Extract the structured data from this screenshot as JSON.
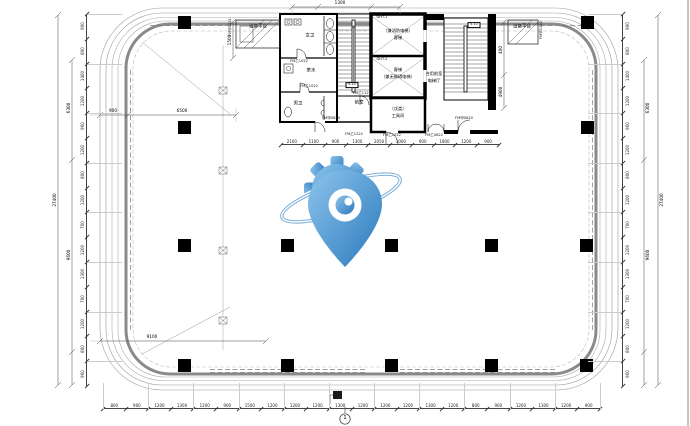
{
  "drawing": {
    "axis_bubble": "1",
    "rooms": {
      "equip_platform_left": "设备平台",
      "equip_platform_right": "设备平台",
      "women_toilet": "女卫",
      "tea_room": "茶水",
      "men_toilet": "男卫",
      "front_room": "前室",
      "lift1_tag": "DHT-1",
      "lift1_line1": "（兼消防电梯）",
      "lift1_line2": "客梯",
      "lift2_tag": "DHT-2",
      "lift2_line1": "客梯",
      "lift2_line2": "（兼无障碍电梯）",
      "tool_room_line1": "（戊类）",
      "tool_room_line2": "工具间",
      "lift_hall_line1": "合用前室",
      "lift_hall_line2": "电梯厅",
      "level_tag_1": "5.11",
      "level_tag_2": "5.11"
    },
    "door_codes": {
      "code0": "FM甲1221",
      "code1": "FM乙1022",
      "code2": "FM乙1022",
      "code3": "FM乙1121",
      "code4": "FM甲0820",
      "code5": "FM乙1222",
      "code6": "FM乙1022",
      "code7": "FM乙0822",
      "code8": "FM甲0820",
      "code9": "FM甲1222"
    },
    "dims": {
      "left_chain": [
        "900",
        "800",
        "1400",
        "1200",
        "900",
        "1200",
        "800",
        "1200",
        "700",
        "1200",
        "1300",
        "700",
        "1200",
        "800",
        "900"
      ],
      "right_chain": [
        "900",
        "800",
        "1400",
        "1200",
        "900",
        "1200",
        "800",
        "1200",
        "700",
        "1200",
        "1300",
        "700",
        "1200",
        "800",
        "900"
      ],
      "bottom_chain": [
        "800",
        "900",
        "1200",
        "1300",
        "1200",
        "900",
        "1500",
        "1200",
        "1200",
        "1200",
        "1300",
        "1200",
        "1200",
        "1200",
        "1300",
        "1200",
        "800",
        "900",
        "1200",
        "1300",
        "1200",
        "900"
      ],
      "core_bottom_chain": [
        "2100",
        "1100",
        "900",
        "1300",
        "2050",
        "1000",
        "900",
        "1800",
        "1200",
        "900"
      ],
      "left_subtotal_upper": "6300",
      "left_subtotal_lower": "9600",
      "left_total": "27400",
      "right_subtotal_upper": "6300",
      "right_subtotal_lower": "9600",
      "right_total": "27400",
      "corner_tl_a": "900",
      "corner_tl_b": "6500",
      "corner_bl": "9100",
      "top_center": "1300",
      "stair_side_a": "400",
      "stair_side_b": "4900",
      "platform_left_v": "1500"
    },
    "icons": {
      "watermark": "gear-location-pin-logo",
      "annotation_flag": "solid-flag-marker"
    },
    "colors": {
      "watermark_blue_light": "#85c1ec",
      "watermark_blue_dark": "#1b6fb8",
      "wall_gray": "#8a8a8a",
      "line_black": "#000000"
    }
  }
}
